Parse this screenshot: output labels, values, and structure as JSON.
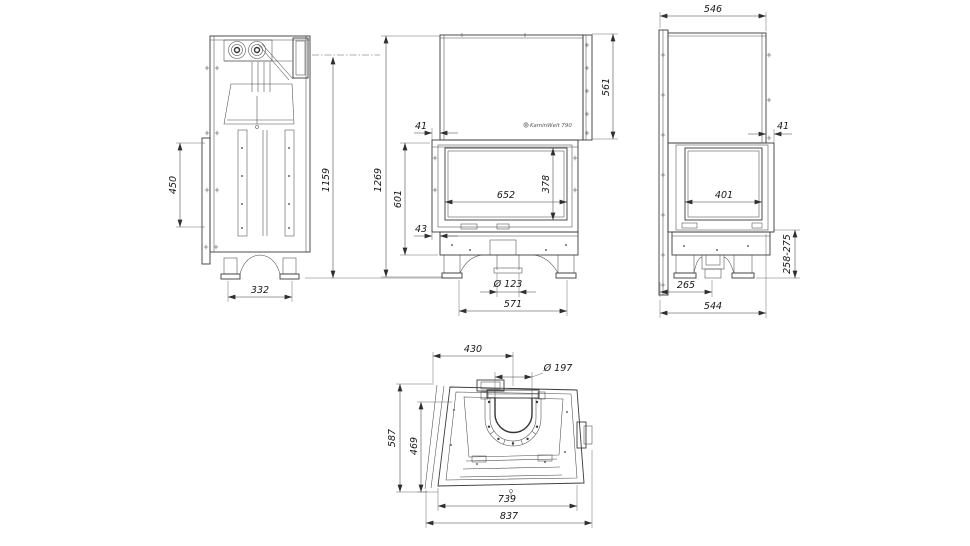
{
  "page": {
    "background": "#ffffff",
    "line_color": "#3a3a3a"
  },
  "brand": {
    "logo_text": "KaminWelt 790",
    "logo_icon": "gear-icon"
  },
  "views": {
    "side_left": {
      "label": "left side view",
      "dims": {
        "inlet_height": "450",
        "body_height": "1159",
        "base_width": "332"
      }
    },
    "front": {
      "label": "front view",
      "dims": {
        "overall_height": "1269",
        "firebox_height": "601",
        "hood_inset": "41",
        "hood_height": "561",
        "glass_width": "652",
        "glass_height": "378",
        "base_inset": "43",
        "air_inlet_diameter": "Ø 123",
        "base_width": "571"
      }
    },
    "side_right": {
      "label": "right side view",
      "dims": {
        "top_depth": "546",
        "hood_inset": "41",
        "glass_width": "401",
        "plinth_height": "258-275",
        "foot_offset": "265",
        "base_depth": "544"
      }
    },
    "top": {
      "label": "top view",
      "dims": {
        "flue_center_offset": "430",
        "flue_diameter": "Ø 197",
        "overall_depth": "587",
        "body_depth": "469",
        "body_width": "739",
        "overall_width": "837"
      }
    }
  }
}
